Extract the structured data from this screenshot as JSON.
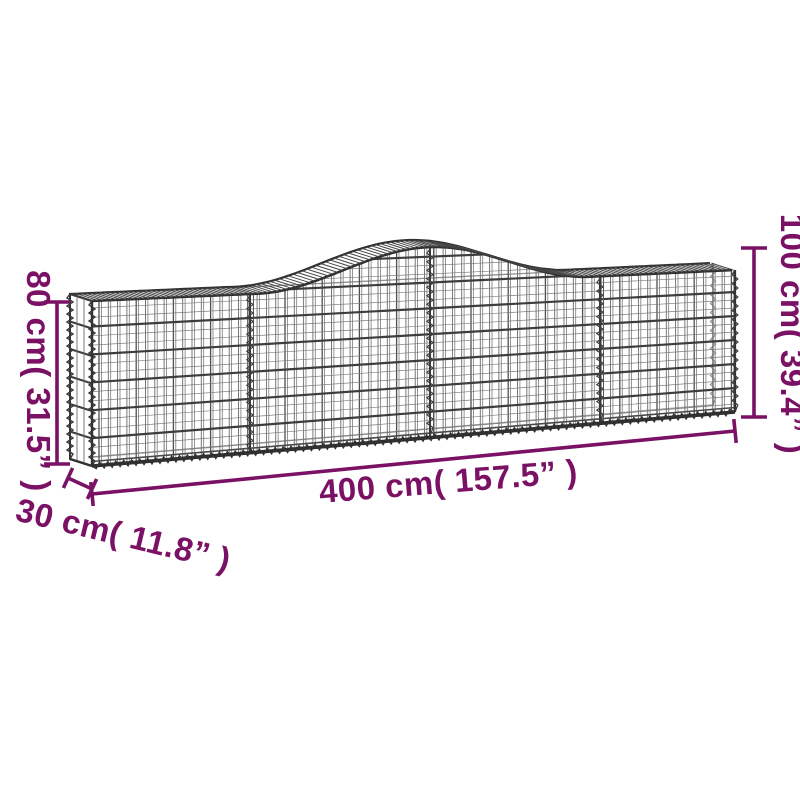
{
  "diagram": {
    "description": "Arched gabion wire-mesh basket shown in perspective with measurement annotations",
    "dimensions": {
      "height_left": "80 cm( 31.5” )",
      "height_right": "100 cm( 39.4” )",
      "depth": "30 cm( 11.8” )",
      "length": "400 cm( 157.5” )"
    },
    "colors": {
      "annotation": "#7a1164",
      "wire_dark": "#3d3d3d",
      "wire_light": "#6a6a6a",
      "background": "#ffffff"
    }
  }
}
